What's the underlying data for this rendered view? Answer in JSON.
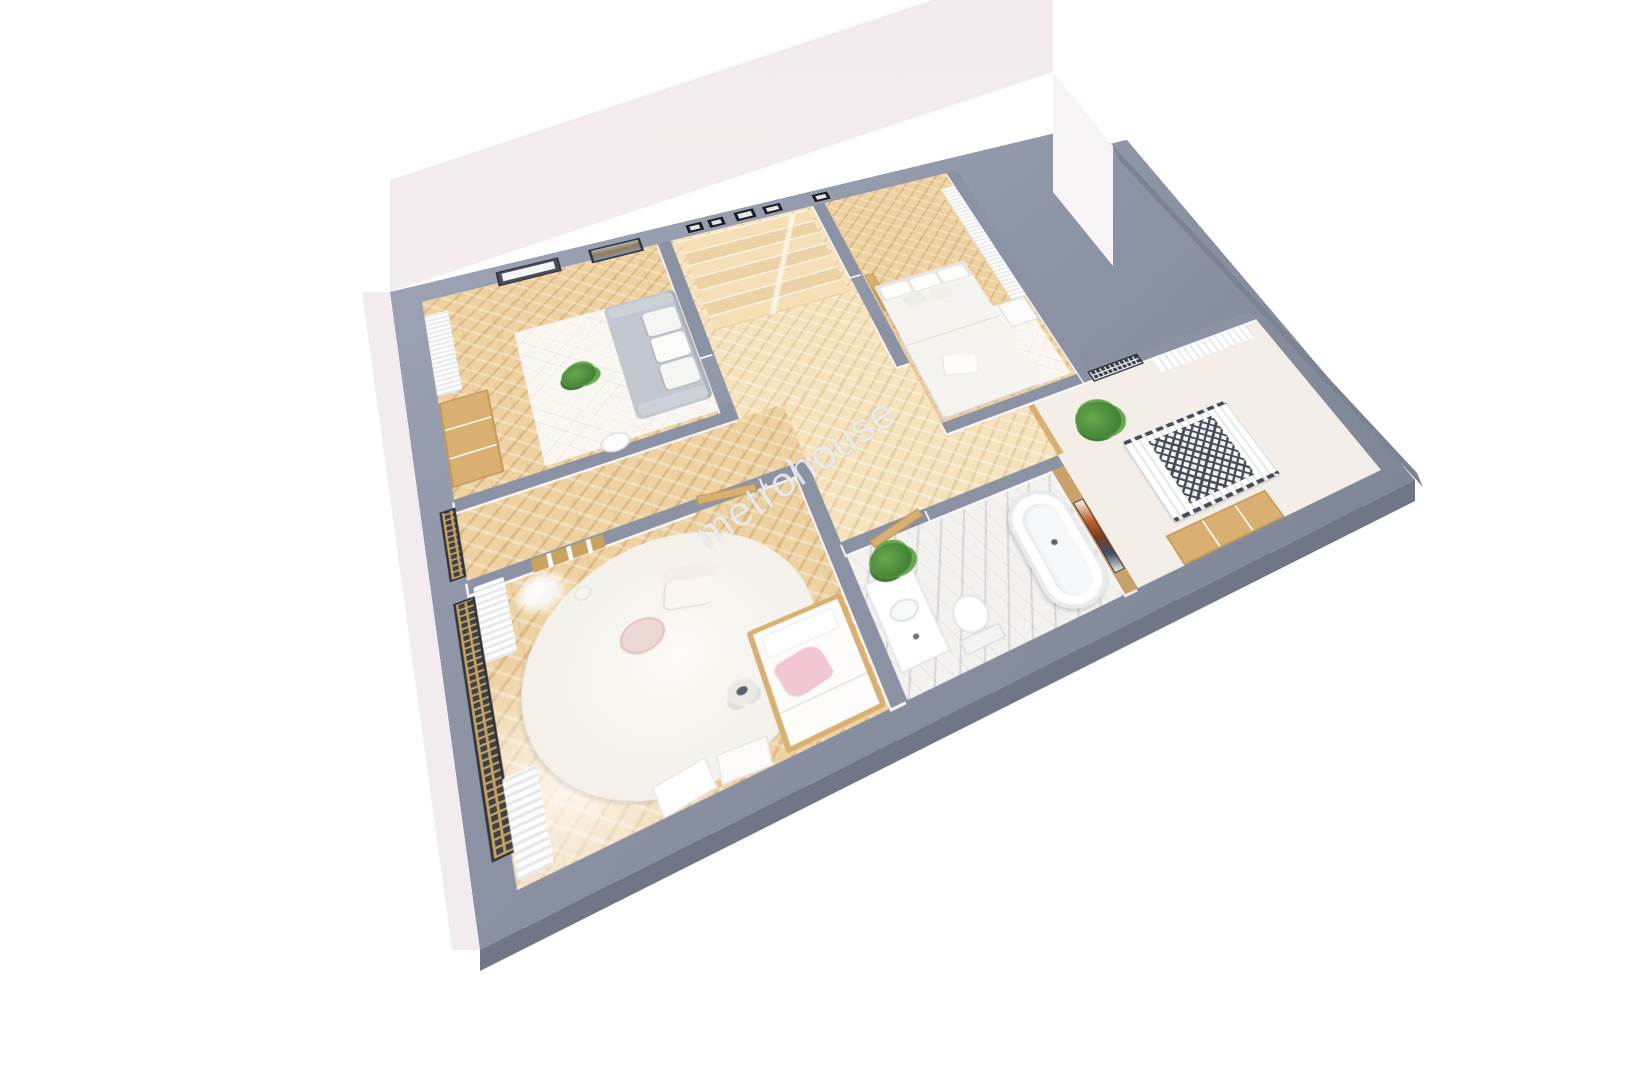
{
  "watermark": {
    "text": "metrohouse"
  },
  "scene": {
    "type": "3d-floor-plan-render",
    "view": "tilted top-down perspective",
    "background": "#ffffff",
    "rooms": [
      {
        "name": "living-room",
        "items": [
          "gray-sofa",
          "white-cushions",
          "wall-art-abstract-blue",
          "window-dark-frame",
          "white-curtains",
          "wood-sideboard",
          "potted-plant",
          "white-rug",
          "stool"
        ]
      },
      {
        "name": "hallway",
        "items": [
          "winder-stairs",
          "small-picture-frames",
          "door-frames"
        ]
      },
      {
        "name": "bedroom",
        "items": [
          "double-bed-white",
          "headboard-pillows",
          "nightstand",
          "long-white-curtain",
          "white-rug"
        ]
      },
      {
        "name": "bathroom",
        "items": [
          "freestanding-bathtub",
          "toilet",
          "sink-counter",
          "potted-palm",
          "marble-floor",
          "wood-accent-wall",
          "abstract-art-orange-blue",
          "wood-door"
        ]
      },
      {
        "name": "kids-room",
        "items": [
          "round-white-rug",
          "armchair",
          "blush-side-table",
          "kids-bed-wood-frame",
          "pink-pillow",
          "white-pillow",
          "teddy-bear",
          "gold-mesh-window",
          "white-curtains",
          "floor-lamp",
          "wall-ladder-decor",
          "leaning-posters"
        ]
      },
      {
        "name": "utility-room",
        "items": [
          "drying-rack-radiator",
          "wood-dresser",
          "palm-plant",
          "mesh-balcony-window",
          "white-blinds"
        ]
      }
    ]
  },
  "theme": {
    "slab": "#8d95a6",
    "slabLight": "#9aa2b3",
    "slabDark": "#7f8797",
    "slabSide": "#6f7787",
    "wallGray": "#8a92a4",
    "tanWall": "#c9a26b",
    "wood": "#eed2a2",
    "woodLight": "#f6e3bd",
    "marble": "#f4f2f1",
    "cream": "#f3efe8",
    "rug": "#faf7f2",
    "sofa": "#c2c8d0",
    "pink": "#f2c6d3",
    "tan": "#d9b071",
    "gold": "#c9a35f",
    "green": "#67a84d",
    "greenDark": "#3c7a30",
    "frameDark": "#3c4048",
    "watermark": "rgba(238,238,243,0.85)"
  }
}
